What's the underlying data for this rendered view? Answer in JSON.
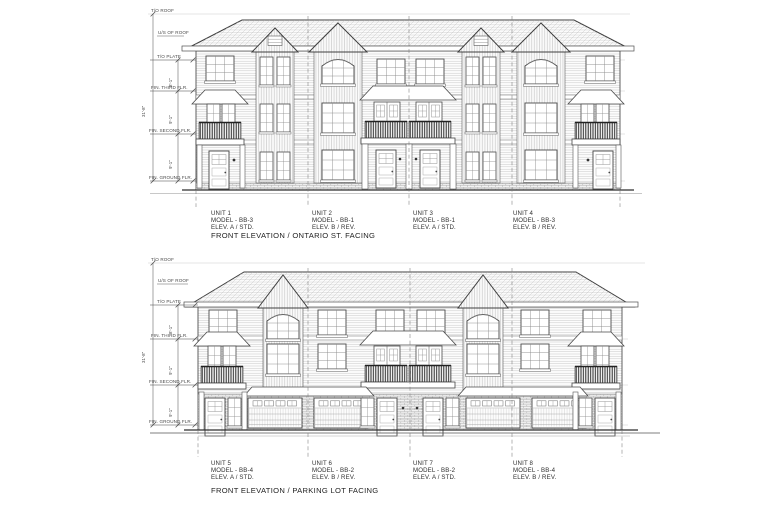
{
  "sheet": {
    "background": "#ffffff",
    "ink": "#3a3a3a"
  },
  "drawings": [
    {
      "title": "FRONT ELEVATION / ONTARIO ST. FACING",
      "units": [
        {
          "name": "UNIT 1",
          "model": "MODEL - BB-3",
          "elev": "ELEV. A / STD."
        },
        {
          "name": "UNIT 2",
          "model": "MODEL - BB-1",
          "elev": "ELEV. B / REV."
        },
        {
          "name": "UNIT 3",
          "model": "MODEL - BB-1",
          "elev": "ELEV. A / STD."
        },
        {
          "name": "UNIT 4",
          "model": "MODEL - BB-3",
          "elev": "ELEV. B / REV."
        }
      ],
      "levels": [
        {
          "label": "T/O ROOF"
        },
        {
          "label": "U/S OF ROOF"
        },
        {
          "label": "T/O PLATE"
        },
        {
          "label": "FIN. THIRD FLR."
        },
        {
          "label": "FIN. SECOND FLR."
        },
        {
          "label": "FIN. GROUND FLR."
        }
      ],
      "dims": {
        "plate_to_third": "8'-1\"",
        "third_to_second": "9'-1\"",
        "second_to_ground": "9'-1\"",
        "overall": "31'-8\""
      }
    },
    {
      "title": "FRONT ELEVATION / PARKING LOT FACING",
      "units": [
        {
          "name": "UNIT 5",
          "model": "MODEL - BB-4",
          "elev": "ELEV. A / STD."
        },
        {
          "name": "UNIT 6",
          "model": "MODEL - BB-2",
          "elev": "ELEV. B / REV."
        },
        {
          "name": "UNIT 7",
          "model": "MODEL - BB-2",
          "elev": "ELEV. A / STD."
        },
        {
          "name": "UNIT 8",
          "model": "MODEL - BB-4",
          "elev": "ELEV. B / REV."
        }
      ],
      "levels": [
        {
          "label": "T/O ROOF"
        },
        {
          "label": "U/S OF ROOF"
        },
        {
          "label": "T/O PLATE"
        },
        {
          "label": "FIN. THIRD FLR."
        },
        {
          "label": "FIN. SECOND FLR."
        },
        {
          "label": "FIN. GROUND FLR."
        }
      ],
      "dims": {
        "plate_to_third": "8'-1\"",
        "third_to_second": "9'-1\"",
        "second_to_ground": "9'-1\"",
        "overall": "31'-8\""
      }
    }
  ]
}
